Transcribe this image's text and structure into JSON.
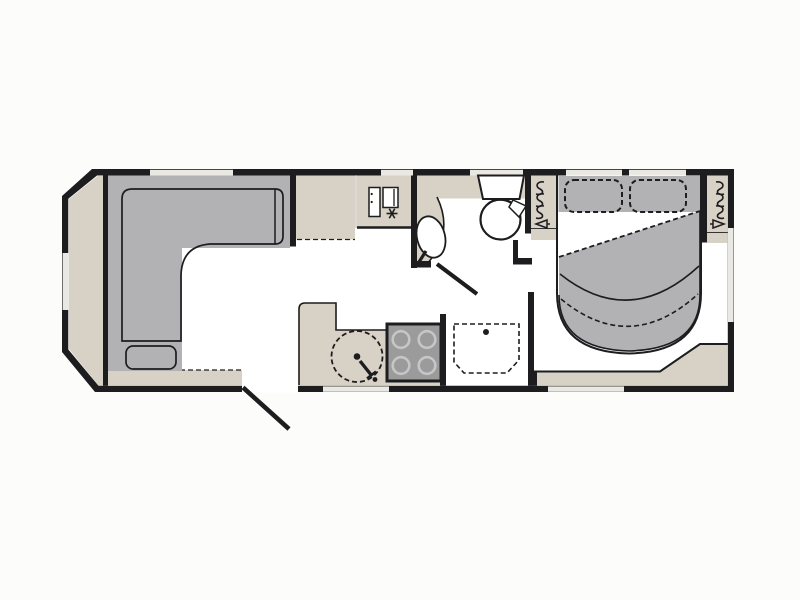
{
  "diagram": {
    "kind": "caravan-floor-plan",
    "colors": {
      "background": "#fcfcfb",
      "wall": "#1d1d1f",
      "floor": "#ffffff",
      "cabinetry": "#d8d2c6",
      "upholstery": "#b2b2b4",
      "hob": "#9b9b9b",
      "hob_burner": "#c6c6c6",
      "window": "#e9e8e2",
      "fixture_white": "#ffffff"
    },
    "zones": [
      {
        "name": "front-lounge",
        "fixtures": [
          "l-shaped-sofa",
          "front-chest",
          "base-ledge"
        ]
      },
      {
        "name": "kitchen",
        "fixtures": [
          "worktop-cabinet",
          "fridge-freezer",
          "round-sink-with-tap",
          "four-burner-hob",
          "stepped-worktop"
        ]
      },
      {
        "name": "washroom",
        "fixtures": [
          "washbasin-with-tap",
          "toilet",
          "shower-tray-with-drain",
          "washroom-door"
        ]
      },
      {
        "name": "rear-bedroom",
        "fixtures": [
          "island-bed",
          "pillow-left",
          "pillow-right",
          "duvet",
          "wardrobe-left",
          "wardrobe-right",
          "bedside-ledge",
          "corner-shelf"
        ]
      }
    ],
    "openings": {
      "entry_door_count": 1,
      "interior_door_count": 1,
      "window_count": 9
    }
  }
}
